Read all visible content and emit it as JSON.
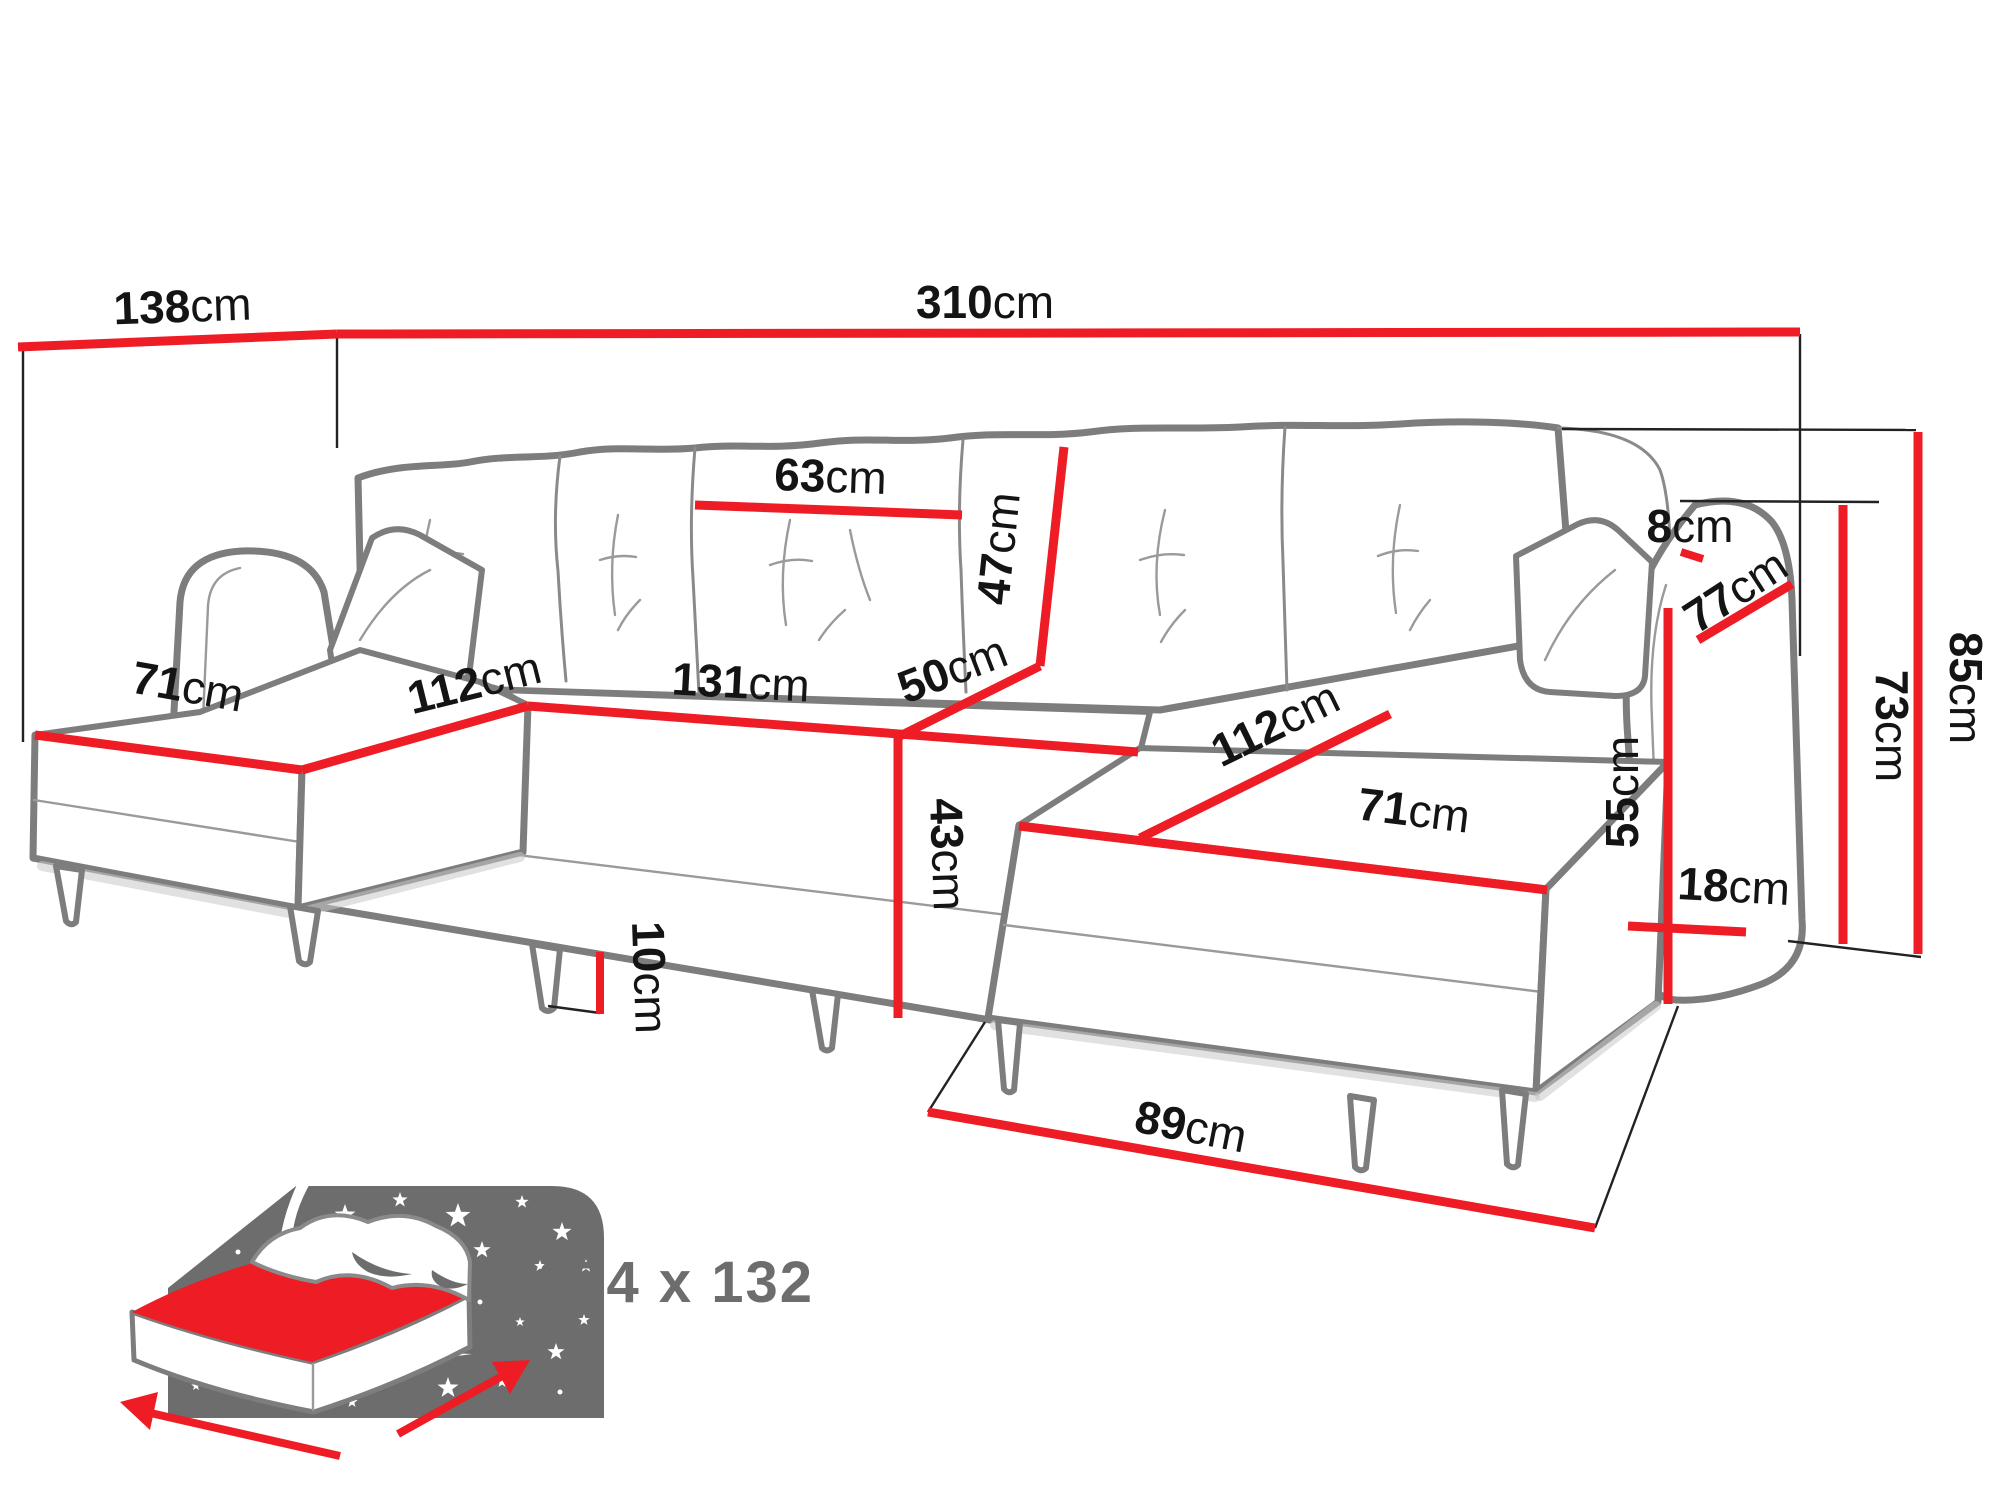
{
  "diagram": {
    "colors": {
      "dimension_line": "#ee1c25",
      "sofa_outline": "#7d7d7d",
      "label_text": "#141414",
      "icon_gray": "#6d6d6d"
    },
    "dimensions": {
      "left_section_depth": {
        "value": "138",
        "unit": "cm"
      },
      "total_width": {
        "value": "310",
        "unit": "cm"
      },
      "back_cushion_width": {
        "value": "63",
        "unit": "cm"
      },
      "back_cushion_height": {
        "value": "47",
        "unit": "cm"
      },
      "middle_seat_width": {
        "value": "131",
        "unit": "cm"
      },
      "seat_depth": {
        "value": "50",
        "unit": "cm"
      },
      "seat_height": {
        "value": "43",
        "unit": "cm"
      },
      "leg_height": {
        "value": "10",
        "unit": "cm"
      },
      "left_chaise_width": {
        "value": "71",
        "unit": "cm"
      },
      "left_chaise_length": {
        "value": "112",
        "unit": "cm"
      },
      "right_chaise_length": {
        "value": "112",
        "unit": "cm"
      },
      "right_chaise_width": {
        "value": "71",
        "unit": "cm"
      },
      "armrest_inner_height": {
        "value": "55",
        "unit": "cm"
      },
      "armrest_width": {
        "value": "18",
        "unit": "cm"
      },
      "back_gap": {
        "value": "8",
        "unit": "cm"
      },
      "armrest_depth": {
        "value": "77",
        "unit": "cm"
      },
      "armrest_height": {
        "value": "73",
        "unit": "cm"
      },
      "total_height": {
        "value": "85",
        "unit": "cm"
      },
      "front_floor_depth": {
        "value": "89",
        "unit": "cm"
      }
    },
    "sleeping_area": {
      "size": "274 x 132"
    },
    "icons": {
      "sleeping_function": "bed-with-starry-headboard-icon"
    }
  }
}
